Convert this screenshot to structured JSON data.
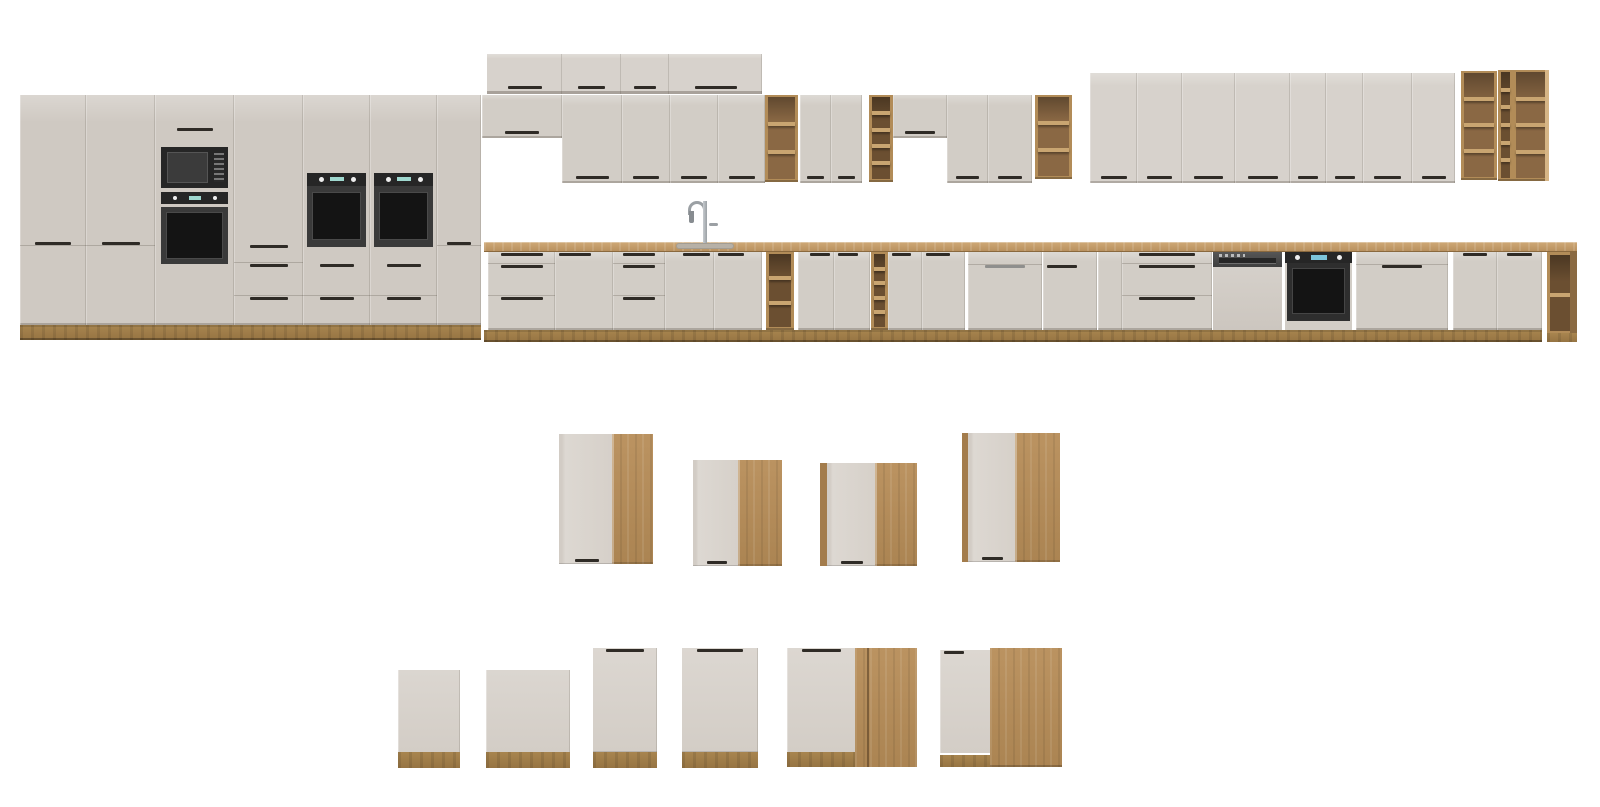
{
  "scene": {
    "width": 1600,
    "height": 807,
    "background": "#ffffff"
  },
  "palette": {
    "front_light": "#d7d2cc",
    "front_mid": "#d2cdc6",
    "front_dark": "#cfc9c2",
    "front_white": "#ddd8d2",
    "edge": "rgba(70,60,48,0.16)",
    "bottom_edge": "rgba(60,50,40,0.25)",
    "handle_dark": "#2f2b26",
    "handle_silver": "#8f8f8d",
    "wood_frame": "#b28c58",
    "wood_light": "#c9a571",
    "wood_panel": "#bb9361",
    "wood_strip": "#a37c4c",
    "wood_int_dark": "#6b4f31",
    "wood_int_wood": "#8a6844",
    "plinth": "#a8854f",
    "counter_hi": "#cfa977",
    "counter_lo": "#b68e5c",
    "counter_edge": "#8a693e",
    "sink_steel": "#b7b1a7",
    "faucet_steel": "#9ba0a4",
    "appliance_black": "#262626",
    "appliance_glass": "#141414",
    "appliance_frame": "#3a3a3a",
    "dw_steel": "#3f3f3f",
    "display_teal": "#9fd8cf",
    "display_blue": "#7cc4da"
  },
  "modules": [
    {
      "name": "tall-pantry-1",
      "type": "tall2door",
      "x": 20,
      "y": 95,
      "w": 66,
      "h": 230
    },
    {
      "name": "tall-pantry-2",
      "type": "tall2door",
      "x": 86,
      "y": 95,
      "w": 69,
      "h": 230
    },
    {
      "name": "tall-oven-microwave-unit",
      "type": "tallMicroOven",
      "x": 155,
      "y": 95,
      "w": 79,
      "h": 230
    },
    {
      "name": "tall-drawer-unit",
      "type": "tallDrawers",
      "x": 234,
      "y": 95,
      "w": 69,
      "h": 230
    },
    {
      "name": "tall-oven-unit-1",
      "type": "tallOven",
      "x": 303,
      "y": 95,
      "w": 67,
      "h": 230
    },
    {
      "name": "tall-oven-unit-2",
      "type": "tallOven",
      "x": 370,
      "y": 95,
      "w": 67,
      "h": 230
    },
    {
      "name": "tall-pantry-3",
      "type": "tall2door",
      "x": 437,
      "y": 95,
      "w": 44,
      "h": 230
    },
    {
      "name": "tall-run-plinth",
      "type": "plinth",
      "x": 20,
      "y": 325,
      "w": 461,
      "h": 15
    },
    {
      "name": "top-box-1",
      "type": "topbox",
      "x": 487,
      "y": 54,
      "w": 75,
      "h": 40
    },
    {
      "name": "top-box-2",
      "type": "topbox",
      "x": 562,
      "y": 54,
      "w": 59,
      "h": 40
    },
    {
      "name": "top-box-3",
      "type": "topbox",
      "x": 621,
      "y": 54,
      "w": 48,
      "h": 40
    },
    {
      "name": "top-box-4",
      "type": "topbox",
      "x": 669,
      "y": 54,
      "w": 93,
      "h": 40
    },
    {
      "name": "wall-cabinet-short-1",
      "type": "door",
      "x": 482,
      "y": 95,
      "w": 80,
      "h": 43,
      "tone": "front_mid",
      "handle": "bc"
    },
    {
      "name": "wall-door-1",
      "type": "door",
      "x": 562,
      "y": 95,
      "w": 60,
      "h": 88,
      "tone": "front_mid",
      "handle": "bc"
    },
    {
      "name": "wall-door-2",
      "type": "door",
      "x": 622,
      "y": 95,
      "w": 48,
      "h": 88,
      "tone": "front_mid",
      "handle": "bc"
    },
    {
      "name": "wall-door-3",
      "type": "door",
      "x": 670,
      "y": 95,
      "w": 48,
      "h": 88,
      "tone": "front_mid",
      "handle": "bc"
    },
    {
      "name": "wall-door-4",
      "type": "door",
      "x": 718,
      "y": 95,
      "w": 47,
      "h": 88,
      "tone": "front_mid",
      "handle": "bc"
    },
    {
      "name": "wall-open-shelf-1",
      "type": "shelf",
      "x": 765,
      "y": 95,
      "w": 33,
      "h": 87,
      "cells": 3,
      "interior": "wood"
    },
    {
      "name": "wall-door-5",
      "type": "door",
      "x": 800,
      "y": 95,
      "w": 31,
      "h": 88,
      "tone": "front_mid",
      "handle": "bc"
    },
    {
      "name": "wall-door-6",
      "type": "door",
      "x": 831,
      "y": 95,
      "w": 31,
      "h": 88,
      "tone": "front_mid",
      "handle": "bc"
    },
    {
      "name": "wall-wine-shelf-1",
      "type": "shelf",
      "x": 869,
      "y": 95,
      "w": 24,
      "h": 87,
      "cells": 5,
      "interior": "dark"
    },
    {
      "name": "wall-cabinet-short-2",
      "type": "door",
      "x": 893,
      "y": 95,
      "w": 54,
      "h": 43,
      "tone": "front_mid",
      "handle": "bc"
    },
    {
      "name": "wall-door-7",
      "type": "door",
      "x": 947,
      "y": 95,
      "w": 41,
      "h": 88,
      "tone": "front_mid",
      "handle": "bc"
    },
    {
      "name": "wall-door-8",
      "type": "door",
      "x": 988,
      "y": 95,
      "w": 44,
      "h": 88,
      "tone": "front_mid",
      "handle": "bc"
    },
    {
      "name": "wall-open-shelf-2",
      "type": "shelf",
      "x": 1035,
      "y": 95,
      "w": 37,
      "h": 84,
      "cells": 3,
      "interior": "wood"
    },
    {
      "name": "wall-tall-door-1",
      "type": "door",
      "x": 1090,
      "y": 73,
      "w": 47,
      "h": 110,
      "tone": "front_light",
      "handle": "bc"
    },
    {
      "name": "wall-tall-door-2",
      "type": "door",
      "x": 1137,
      "y": 73,
      "w": 45,
      "h": 110,
      "tone": "front_light",
      "handle": "bc"
    },
    {
      "name": "wall-tall-door-3",
      "type": "door",
      "x": 1182,
      "y": 73,
      "w": 53,
      "h": 110,
      "tone": "front_light",
      "handle": "bc"
    },
    {
      "name": "wall-tall-door-4",
      "type": "door",
      "x": 1235,
      "y": 73,
      "w": 55,
      "h": 110,
      "tone": "front_light",
      "handle": "bc"
    },
    {
      "name": "wall-tall-door-5",
      "type": "door",
      "x": 1290,
      "y": 73,
      "w": 36,
      "h": 110,
      "tone": "front_light",
      "handle": "bc"
    },
    {
      "name": "wall-tall-door-6",
      "type": "door",
      "x": 1326,
      "y": 73,
      "w": 37,
      "h": 110,
      "tone": "front_light",
      "handle": "bc"
    },
    {
      "name": "wall-tall-door-7",
      "type": "door",
      "x": 1363,
      "y": 73,
      "w": 49,
      "h": 110,
      "tone": "front_light",
      "handle": "bc"
    },
    {
      "name": "wall-tall-door-8",
      "type": "door",
      "x": 1412,
      "y": 73,
      "w": 43,
      "h": 110,
      "tone": "front_light",
      "handle": "bc"
    },
    {
      "name": "wall-open-shelf-3",
      "type": "shelf",
      "x": 1461,
      "y": 71,
      "w": 36,
      "h": 109,
      "cells": 4,
      "interior": "wood"
    },
    {
      "name": "wall-wine-shelf-2",
      "type": "shelf",
      "x": 1498,
      "y": 70,
      "w": 15,
      "h": 111,
      "cells": 6,
      "interior": "dark"
    },
    {
      "name": "wall-open-shelf-4",
      "type": "shelf",
      "x": 1513,
      "y": 70,
      "w": 36,
      "h": 111,
      "cells": 4,
      "interior": "wood",
      "highlight": true
    },
    {
      "name": "countertop",
      "type": "counter",
      "x": 484,
      "y": 242,
      "w": 1093,
      "h": 10
    },
    {
      "name": "sink-cutout",
      "type": "sink",
      "x": 676,
      "y": 243,
      "w": 58,
      "h": 6
    },
    {
      "name": "faucet",
      "type": "faucet",
      "x": 688,
      "y": 199,
      "w": 32,
      "h": 44
    },
    {
      "name": "base-drawers-1",
      "type": "drawers3",
      "x": 488,
      "y": 252,
      "w": 67,
      "h": 78
    },
    {
      "name": "base-door-1",
      "type": "door",
      "x": 555,
      "y": 252,
      "w": 58,
      "h": 78,
      "tone": "front_mid",
      "handle": "tl"
    },
    {
      "name": "base-drawers-2",
      "type": "drawers3",
      "x": 613,
      "y": 252,
      "w": 52,
      "h": 78
    },
    {
      "name": "base-sink-door-left",
      "type": "door",
      "x": 665,
      "y": 252,
      "w": 49,
      "h": 78,
      "tone": "front_mid",
      "handle": "tr"
    },
    {
      "name": "base-sink-door-right",
      "type": "door",
      "x": 714,
      "y": 252,
      "w": 48,
      "h": 78,
      "tone": "front_mid",
      "handle": "tl"
    },
    {
      "name": "base-open-shelf-1",
      "type": "shelf",
      "x": 766,
      "y": 252,
      "w": 28,
      "h": 78,
      "cells": 3,
      "interior": "dark"
    },
    {
      "name": "base-door-2",
      "type": "door",
      "x": 798,
      "y": 252,
      "w": 36,
      "h": 78,
      "tone": "front_mid",
      "handle": "tr"
    },
    {
      "name": "base-door-3",
      "type": "door",
      "x": 834,
      "y": 252,
      "w": 36,
      "h": 78,
      "tone": "front_mid",
      "handle": "tl"
    },
    {
      "name": "base-wine-shelf",
      "type": "shelf",
      "x": 871,
      "y": 252,
      "w": 17,
      "h": 78,
      "cells": 5,
      "interior": "dark"
    },
    {
      "name": "base-door-4",
      "type": "door",
      "x": 888,
      "y": 252,
      "w": 34,
      "h": 78,
      "tone": "front_mid",
      "handle": "tl"
    },
    {
      "name": "base-door-5",
      "type": "door",
      "x": 922,
      "y": 252,
      "w": 43,
      "h": 78,
      "tone": "front_mid",
      "handle": "tl"
    },
    {
      "name": "integrated-dishwasher-panel-1",
      "type": "dwpanel",
      "x": 968,
      "y": 252,
      "w": 74,
      "h": 78,
      "metal": "silver"
    },
    {
      "name": "base-door-6",
      "type": "door",
      "x": 1043,
      "y": 252,
      "w": 54,
      "h": 78,
      "tone": "front_mid",
      "handle": "tl",
      "handleY": 13
    },
    {
      "name": "base-filler-door",
      "type": "door",
      "x": 1098,
      "y": 252,
      "w": 24,
      "h": 78,
      "tone": "front_mid",
      "handle": "none"
    },
    {
      "name": "base-drawers-3",
      "type": "drawers3",
      "x": 1122,
      "y": 252,
      "w": 90,
      "h": 78
    },
    {
      "name": "semi-integrated-dishwasher",
      "type": "dwsemi",
      "x": 1213,
      "y": 252,
      "w": 69,
      "h": 78
    },
    {
      "name": "built-in-oven-base",
      "type": "ovenbase",
      "x": 1285,
      "y": 252,
      "w": 67,
      "h": 78
    },
    {
      "name": "integrated-dishwasher-panel-2",
      "type": "dwpanel",
      "x": 1356,
      "y": 252,
      "w": 92,
      "h": 78,
      "metal": "dark"
    },
    {
      "name": "base-door-7",
      "type": "door",
      "x": 1453,
      "y": 252,
      "w": 44,
      "h": 78,
      "tone": "front_mid",
      "handle": "tc"
    },
    {
      "name": "base-door-8",
      "type": "door",
      "x": 1497,
      "y": 252,
      "w": 45,
      "h": 78,
      "tone": "front_mid",
      "handle": "tc"
    },
    {
      "name": "base-plinth",
      "type": "plinth",
      "x": 484,
      "y": 330,
      "w": 1058,
      "h": 12
    },
    {
      "name": "corner-open-shelf",
      "type": "woodcorner",
      "x": 1547,
      "y": 252,
      "w": 30,
      "h": 90
    },
    {
      "name": "corner-wall-cabinet-1",
      "type": "cornerwall",
      "x": 559,
      "y": 434,
      "w": 94,
      "h": 130,
      "strip": 0,
      "white": 53,
      "handle": true
    },
    {
      "name": "corner-wall-cabinet-2",
      "type": "cornerwall",
      "x": 693,
      "y": 460,
      "w": 89,
      "h": 106,
      "strip": 0,
      "white": 45,
      "handle": true
    },
    {
      "name": "corner-wall-cabinet-3",
      "type": "cornerwall",
      "x": 820,
      "y": 463,
      "w": 97,
      "h": 103,
      "strip": 7,
      "white": 48,
      "handle": true
    },
    {
      "name": "corner-wall-cabinet-4",
      "type": "cornerwall",
      "x": 962,
      "y": 433,
      "w": 98,
      "h": 129,
      "strip": 6,
      "white": 47,
      "handle": true
    },
    {
      "name": "appliance-front-panel-1",
      "type": "basepanel",
      "x": 398,
      "y": 670,
      "w": 62,
      "h": 98
    },
    {
      "name": "appliance-front-panel-2",
      "type": "basepanel",
      "x": 486,
      "y": 670,
      "w": 84,
      "h": 98
    },
    {
      "name": "base-front-door-1",
      "type": "basedoor",
      "x": 593,
      "y": 648,
      "w": 64,
      "h": 120
    },
    {
      "name": "base-front-door-2",
      "type": "basedoor",
      "x": 682,
      "y": 648,
      "w": 76,
      "h": 120
    },
    {
      "name": "corner-base-cabinet-1",
      "type": "cornerbase",
      "x": 787,
      "y": 648,
      "w": 130,
      "h": 119,
      "white": 68,
      "seam": 80
    },
    {
      "name": "corner-base-cabinet-2",
      "type": "cornerbase2",
      "x": 940,
      "y": 648,
      "w": 122,
      "h": 119,
      "white": 50
    }
  ]
}
